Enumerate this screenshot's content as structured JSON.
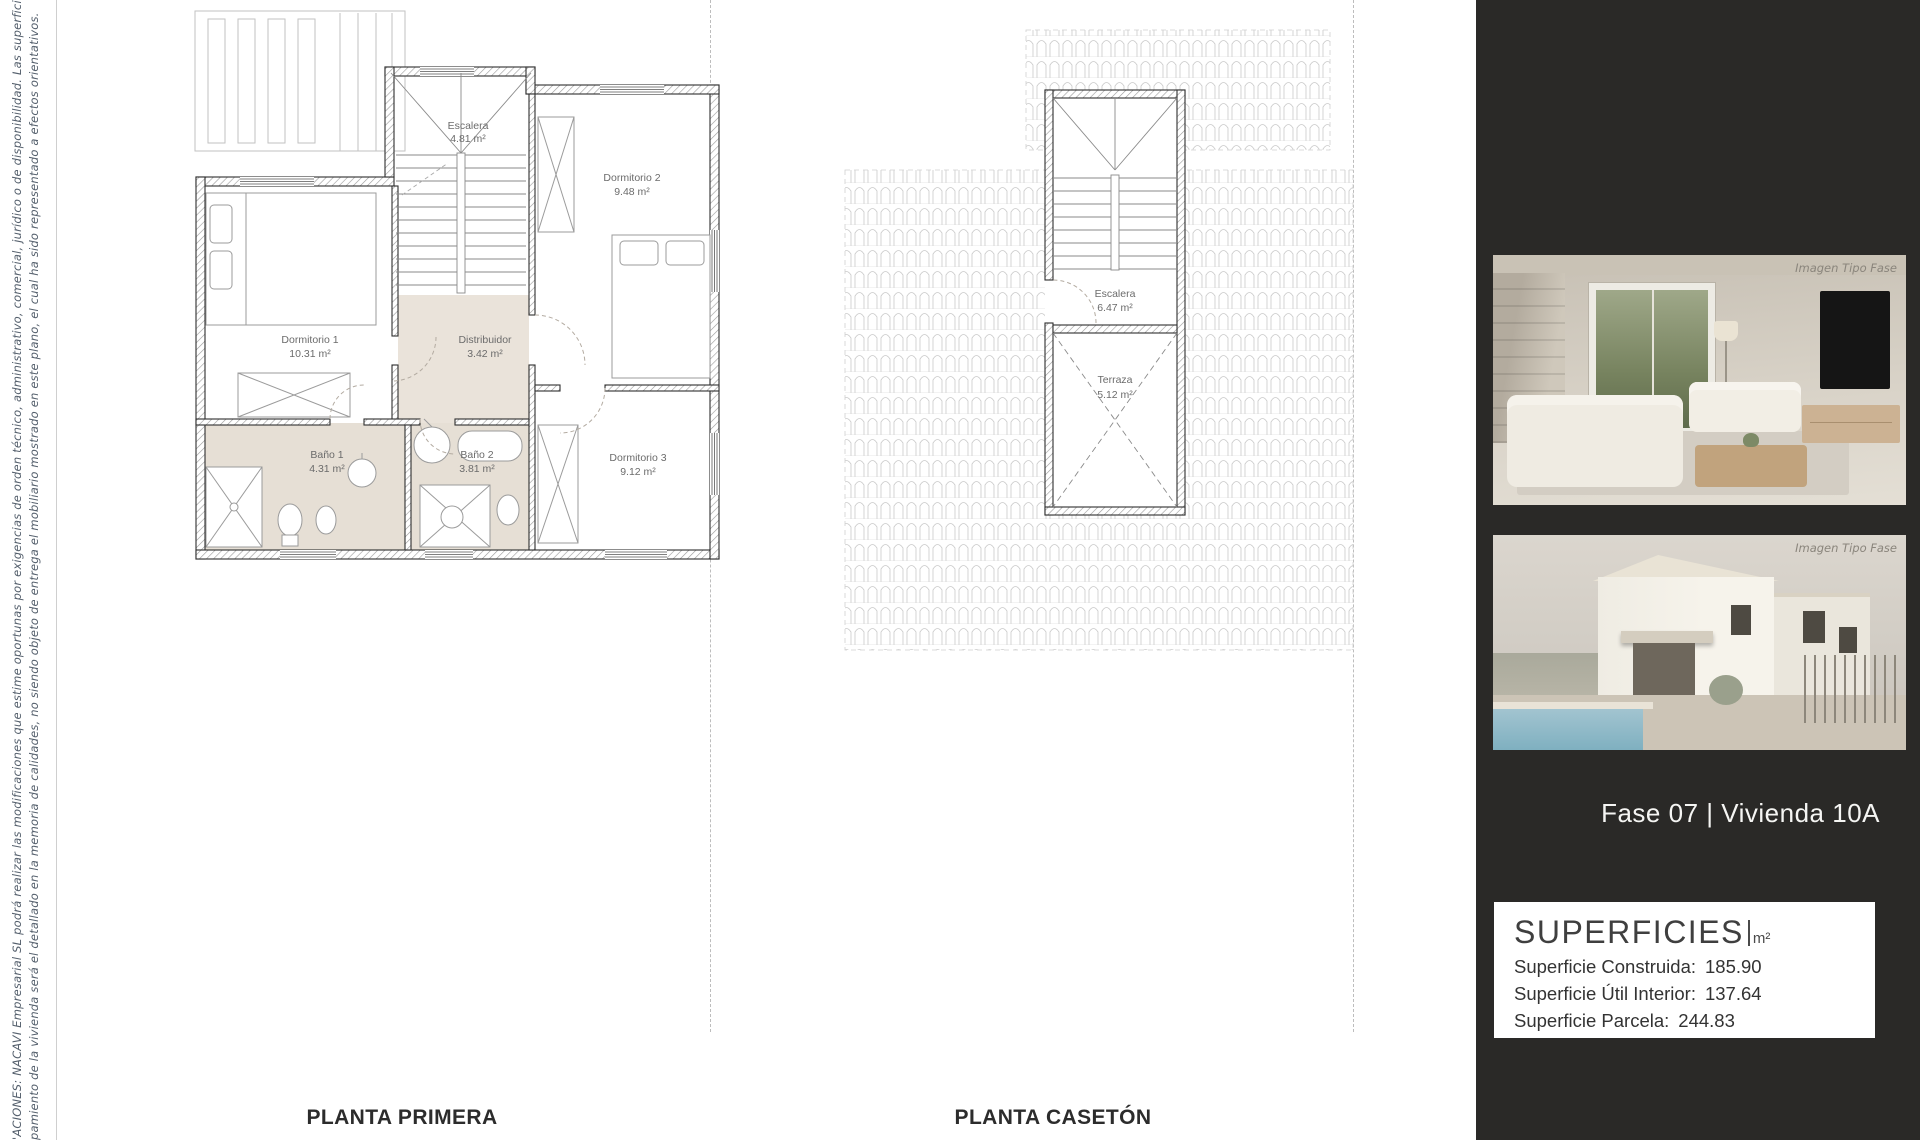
{
  "disclaimer": {
    "line1": "'ACIONES: NACAVI Empresarial SL podrá realizar las modificaciones que estime oportunas por exigencias de orden técnico, administrativo, comercial, jurídico o de disponibilidad. Las superficies útiles y constructivas son ap",
    "line2": "pamiento de la vivienda será el detallado en la memoria de calidades, no siendo objeto de entrega el mobiliario mostrado en este plano, el cual ha sido representado a efectos orientativos."
  },
  "plan_primera": {
    "title": "PLANTA PRIMERA",
    "rooms": {
      "escalera": {
        "name": "Escalera",
        "area": "4.81 m²"
      },
      "dormitorio2": {
        "name": "Dormitorio 2",
        "area": "9.48 m²"
      },
      "dormitorio1": {
        "name": "Dormitorio 1",
        "area": "10.31 m²"
      },
      "distribuidor": {
        "name": "Distribuidor",
        "area": "3.42 m²"
      },
      "bano1": {
        "name": "Baño 1",
        "area": "4.31 m²"
      },
      "bano2": {
        "name": "Baño 2",
        "area": "3.81 m²"
      },
      "dormitorio3": {
        "name": "Dormitorio 3",
        "area": "9.12 m²"
      }
    }
  },
  "plan_caseton": {
    "title": "PLANTA CASETÓN",
    "rooms": {
      "escalera": {
        "name": "Escalera",
        "area": "6.47 m²"
      },
      "terraza": {
        "name": "Terraza",
        "area": "5.12 m²"
      }
    }
  },
  "side_panel": {
    "photo_caption": "Imagen Tipo Fase",
    "unit_label": "Fase 07 |  Vivienda 10A",
    "superficies": {
      "title": "SUPERFICIES",
      "unit": "m²",
      "rows": [
        {
          "label": "Superficie Construida:",
          "value": "185.90"
        },
        {
          "label": "Superficie Útil Interior:",
          "value": "137.64"
        },
        {
          "label": "Superficie Parcela:",
          "value": "244.83"
        }
      ]
    }
  },
  "colors": {
    "panel_bg": "#2a2927",
    "plan_floor_beige": "#e6dfd5",
    "wall_stroke": "#2f2f2f"
  }
}
